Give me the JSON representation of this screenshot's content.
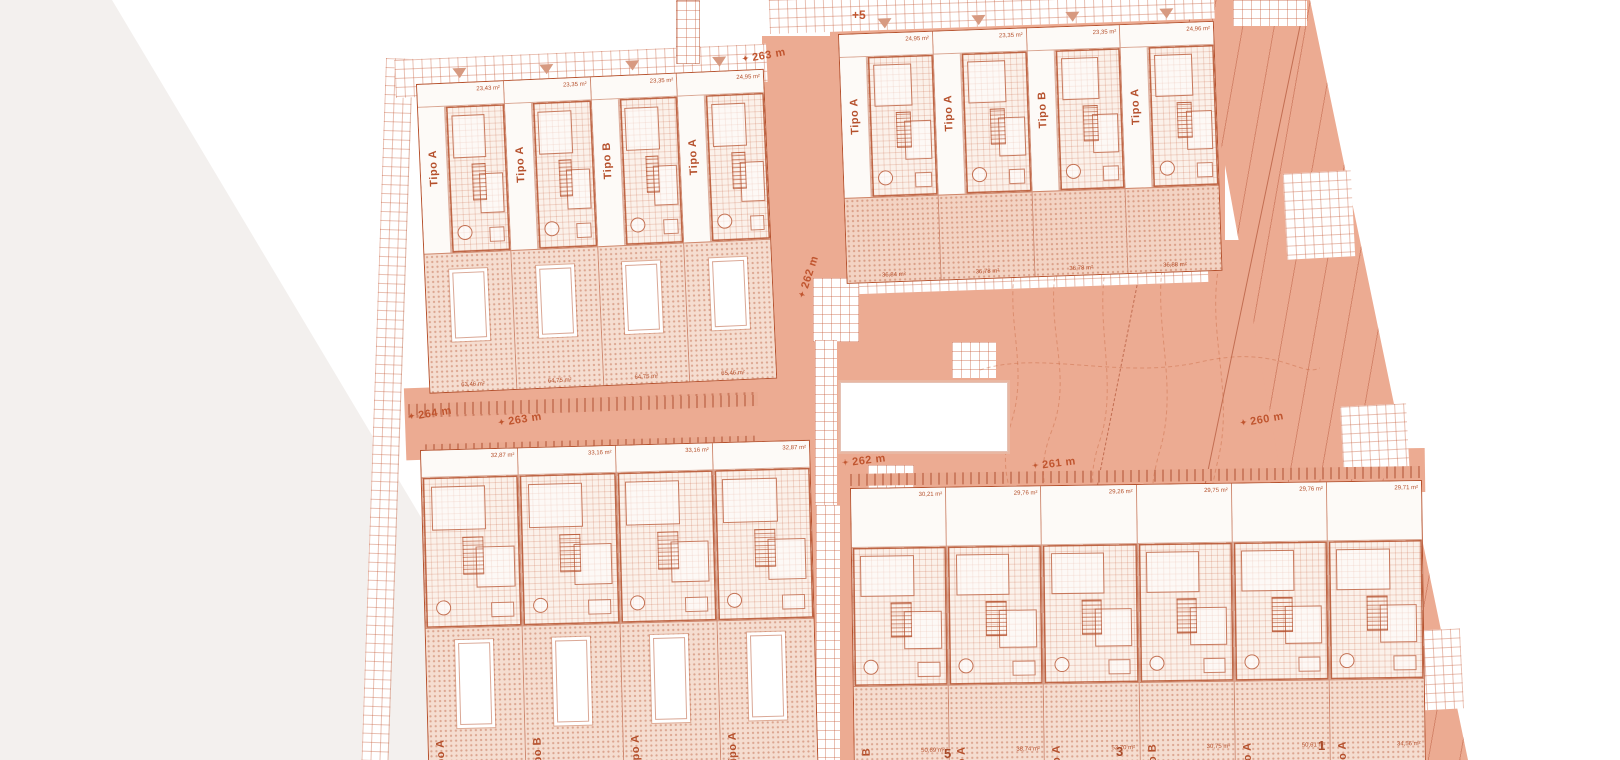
{
  "drawing": {
    "type": "residential site plan",
    "language": "Spanish"
  },
  "colors": {
    "accent_line": "#b5502c",
    "salmon_fill": "#ecab92",
    "stipple_fill": "#f5ddd0",
    "paper_grey": "#f3f0ee",
    "marker_text": "#c0552f"
  },
  "annotations": {
    "plus_level": "+5",
    "unit_numbers": [
      "5",
      "3",
      "1"
    ]
  },
  "markers": [
    {
      "label": "263 m"
    },
    {
      "label": "262 m"
    },
    {
      "label": "264 m"
    },
    {
      "label": "263 m"
    },
    {
      "label": "262 m"
    },
    {
      "label": "261 m"
    },
    {
      "label": "260 m"
    }
  ],
  "blocks": {
    "top_left": {
      "units": [
        {
          "tipo": "Tipo A",
          "floor_area": "23,43 m²",
          "outdoor_area": "63,46 m²"
        },
        {
          "tipo": "Tipo A",
          "floor_area": "23,35 m²",
          "outdoor_area": "64,75 m²"
        },
        {
          "tipo": "Tipo B",
          "floor_area": "23,35 m²",
          "outdoor_area": "64,75 m²"
        },
        {
          "tipo": "Tipo A",
          "floor_area": "24,95 m²",
          "outdoor_area": "65,46 m²"
        }
      ]
    },
    "top_right": {
      "units": [
        {
          "tipo": "Tipo A",
          "floor_area": "24,95 m²",
          "outdoor_area": "36,84 m²"
        },
        {
          "tipo": "Tipo A",
          "floor_area": "23,35 m²",
          "outdoor_area": "36,78 m²"
        },
        {
          "tipo": "Tipo B",
          "floor_area": "23,35 m²",
          "outdoor_area": "36,78 m²"
        },
        {
          "tipo": "Tipo A",
          "floor_area": "24,96 m²",
          "outdoor_area": "36,88 m²"
        }
      ]
    },
    "bottom_left": {
      "units": [
        {
          "tipo": "Tipo A",
          "floor_area": "32,87 m²",
          "outdoor_area": ""
        },
        {
          "tipo": "Tipo B",
          "floor_area": "33,16 m²",
          "outdoor_area": ""
        },
        {
          "tipo": "Tipo A",
          "floor_area": "33,16 m²",
          "outdoor_area": ""
        },
        {
          "tipo": "Tipo A",
          "floor_area": "32,87 m²",
          "outdoor_area": ""
        }
      ]
    },
    "bottom_right": {
      "units": [
        {
          "tipo": "Tipo B",
          "floor_area": "30,21 m²",
          "outdoor_area": "50,69 m²"
        },
        {
          "tipo": "Tipo A",
          "floor_area": "29,76 m²",
          "outdoor_area": "38,74 m²"
        },
        {
          "tipo": "Tipo A",
          "floor_area": "29,26 m²",
          "outdoor_area": "52,70 m²"
        },
        {
          "tipo": "Tipo B",
          "floor_area": "29,75 m²",
          "outdoor_area": "30,75 m²"
        },
        {
          "tipo": "Tipo A",
          "floor_area": "29,76 m²",
          "outdoor_area": "50,61 m²"
        },
        {
          "tipo": "Tipo A",
          "floor_area": "29,71 m²",
          "outdoor_area": "34,56 m²"
        }
      ]
    }
  }
}
